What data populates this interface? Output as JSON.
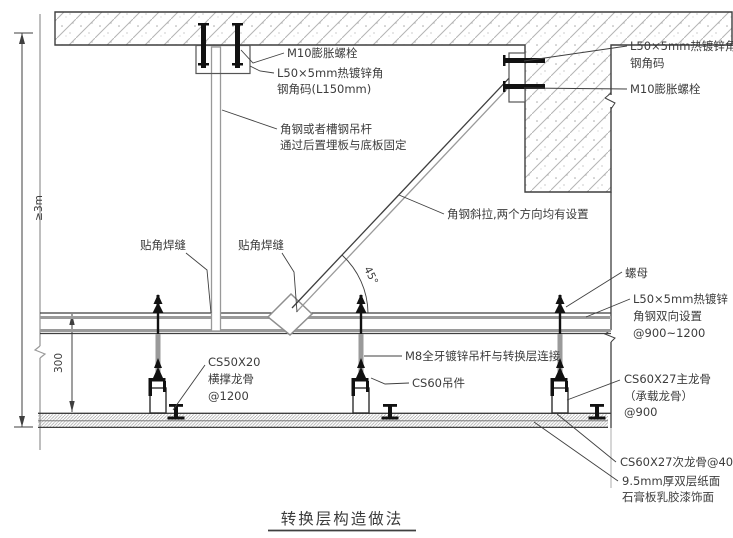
{
  "title": "转换层构造做法",
  "dims": {
    "overall_height": "≥3m",
    "transfer_offset": "300",
    "brace_angle": "45°"
  },
  "callouts": {
    "m10_top": "M10膨胀螺栓",
    "bracket_top1": "L50×5mm热镀锌角",
    "bracket_top2": "钢角码(L150mm)",
    "hanger1": "角钢或者槽钢吊杆",
    "hanger2": "通过后置埋板与底板固定",
    "bracket_right1": "L50×5mm热镀锌角",
    "bracket_right2": "钢角码",
    "m10_right": "M10膨胀螺栓",
    "brace": "角钢斜拉,两个方向均有设置",
    "weld_left": "贴角焊缝",
    "weld_right": "贴角焊缝",
    "nut": "螺母",
    "transfer1": "L50×5mm热镀锌",
    "transfer2": "角钢双向设置",
    "transfer3": "@900~1200",
    "m8_rod": "M8全牙镀锌吊杆与转换层连接",
    "cs60": "CS60吊件",
    "cs50_1": "CS50X20",
    "cs50_2": "横撑龙骨",
    "cs50_3": "@1200",
    "main1": "CS60X27主龙骨",
    "main2": "（承载龙骨）",
    "main3": "@900",
    "sub": "CS60X27次龙骨@400",
    "gyp1": "9.5mm厚双层纸面",
    "gyp2": "石膏板乳胶漆饰面"
  },
  "colors": {
    "line": "#3c3c3c",
    "steel_gray": "#9a9a9a",
    "hatch": "#b4b4b4",
    "black_hardware": "#111111"
  }
}
